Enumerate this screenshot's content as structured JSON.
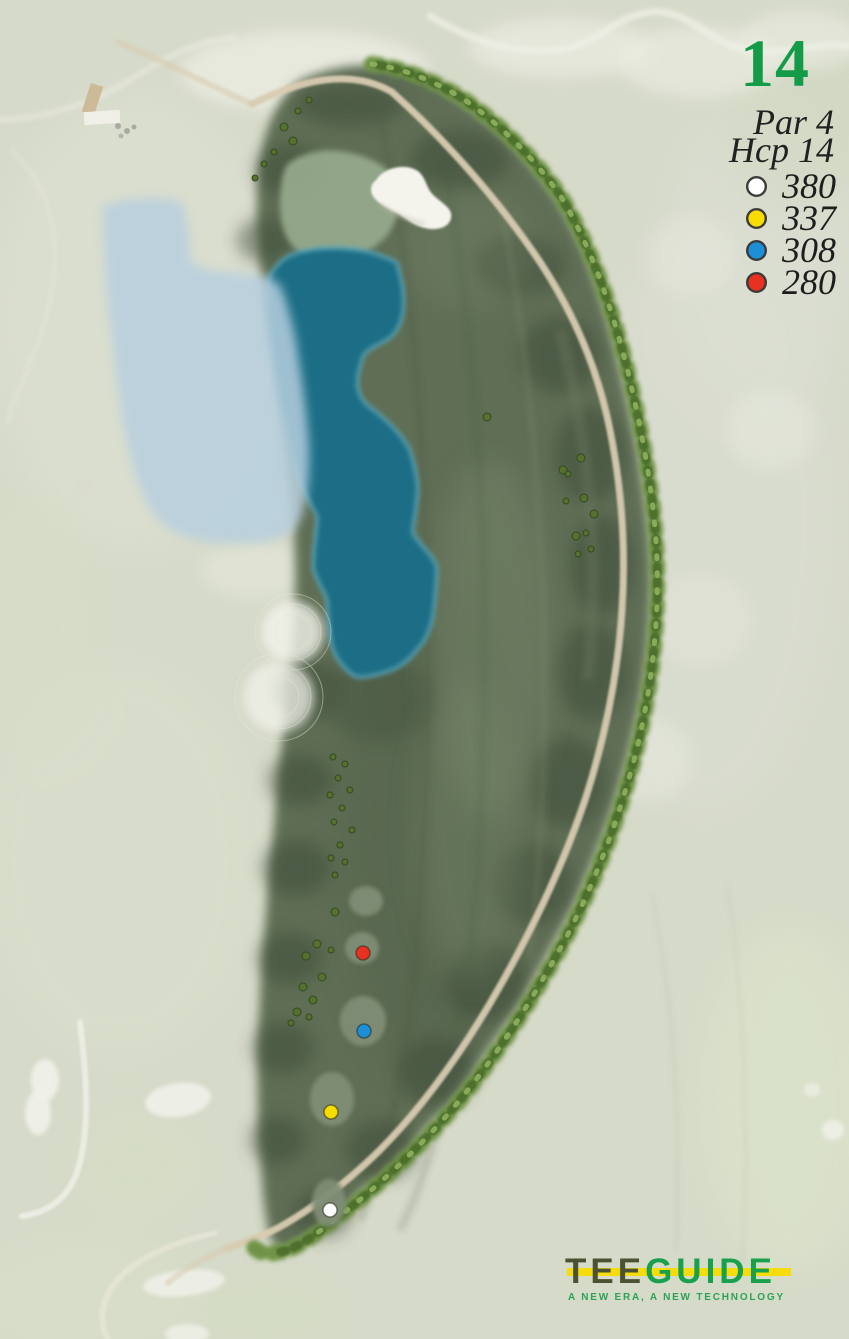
{
  "hole": {
    "number": "14",
    "par_label": "Par 4",
    "handicap_label": "Hcp 14",
    "tees": [
      {
        "name": "white",
        "color": "#ffffff",
        "distance": "380"
      },
      {
        "name": "yellow",
        "color": "#f8dc00",
        "distance": "337"
      },
      {
        "name": "blue",
        "color": "#1d8fd8",
        "distance": "308"
      },
      {
        "name": "red",
        "color": "#e93122",
        "distance": "280"
      }
    ]
  },
  "branding": {
    "logo_part1": "TEE",
    "logo_part2": "GUIDE",
    "tagline": "A NEW ERA, A NEW TECHNOLOGY",
    "colors": {
      "hole_number_green": "#149b48",
      "logo_tee_dark": "#4a5233",
      "logo_guide_green": "#18a14c",
      "logo_bar_yellow": "#f6dc0c",
      "tagline_green": "#2ba455",
      "info_text": "#1d1d1d"
    }
  },
  "map": {
    "kind": "aerial-golf-hole-map",
    "features": [
      "clubhouse-buildings",
      "putting-green",
      "greenside-bunker",
      "water-hazard",
      "shallow-water-overlay",
      "fairway",
      "cart-path",
      "tree-line",
      "scattered-trees",
      "tee-boxes",
      "tee-markers",
      "faded-neighbor-holes",
      "faded-bunkers",
      "faded-roads"
    ],
    "palette": {
      "terrain": "#d6dac9",
      "fairway": "#5e6e55",
      "rough_shadow": "#3e4c38",
      "green": "#96aa8d",
      "bunker": "#f4f3ec",
      "water": "#1e6e86",
      "water_edge": "#57a8bc",
      "shallow_overlay": "#b7cfdf",
      "cart_path": "#d9ccb2",
      "trees": "#6b9040",
      "tee_box": "#808e76"
    }
  }
}
